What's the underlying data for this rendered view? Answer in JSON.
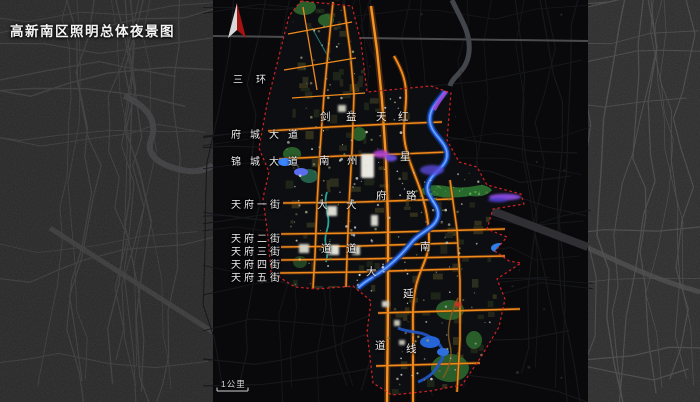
{
  "title": "高新南区照明总体夜景图",
  "compass": {
    "icon": "north-arrow",
    "red": "#a51212",
    "white": "#d8d8d8"
  },
  "scale_bar": {
    "label": "1公里"
  },
  "colors": {
    "road_orange": "#ef8a1c",
    "river_blue": "#2563e8",
    "boundary_red": "#d42222",
    "park_green": "#2f6b2f",
    "label_white": "#ececec",
    "background_dark": "#09090c"
  },
  "map_labels": {
    "horizontal": [
      {
        "id": "third-ring-road",
        "text": "三环",
        "x": 233,
        "y": 71,
        "spacing": 13
      },
      {
        "id": "fucheng-avenue",
        "text": "府城大道",
        "x": 231,
        "y": 126,
        "spacing": 9
      },
      {
        "id": "jincheng-avenue",
        "text": "锦城大道",
        "x": 231,
        "y": 153,
        "spacing": 9
      },
      {
        "id": "tianfu-1st-street",
        "text": "天府一街",
        "x": 231,
        "y": 196,
        "spacing": 3
      },
      {
        "id": "tianfu-2nd-street",
        "text": "天府二街",
        "x": 231,
        "y": 230,
        "spacing": 3
      },
      {
        "id": "tianfu-3rd-street",
        "text": "天府三街",
        "x": 231,
        "y": 243,
        "spacing": 3
      },
      {
        "id": "tianfu-4th-street",
        "text": "天府四街",
        "x": 231,
        "y": 256,
        "spacing": 3
      },
      {
        "id": "tianfu-5th-street",
        "text": "天府五街",
        "x": 231,
        "y": 269,
        "spacing": 3
      }
    ],
    "vertical_roads": [
      {
        "id": "jiannan-avenue",
        "label": "剑南大道",
        "chars": [
          [
            "剑",
            320,
            112
          ],
          [
            "南",
            319,
            156
          ],
          [
            "大",
            317,
            200
          ],
          [
            "道",
            321,
            244
          ]
        ]
      },
      {
        "id": "yizhou-avenue",
        "label": "益州大道",
        "chars": [
          [
            "益",
            346,
            112
          ],
          [
            "州",
            347,
            156
          ],
          [
            "大",
            346,
            200
          ],
          [
            "道",
            346,
            244
          ]
        ]
      },
      {
        "id": "tianfu-avenue",
        "label": "天府大道",
        "chars": [
          [
            "天",
            376,
            112
          ],
          [
            "府",
            376,
            191
          ],
          [
            "大",
            366,
            267
          ],
          [
            "道",
            375,
            341
          ]
        ]
      },
      {
        "id": "hongxing-road-south-extension",
        "label": "红星路南延线",
        "chars": [
          [
            "红",
            398,
            112
          ],
          [
            "星",
            400,
            152
          ],
          [
            "路",
            406,
            191
          ],
          [
            "南",
            420,
            242
          ],
          [
            "延",
            403,
            289
          ],
          [
            "线",
            406,
            344
          ]
        ]
      }
    ]
  }
}
